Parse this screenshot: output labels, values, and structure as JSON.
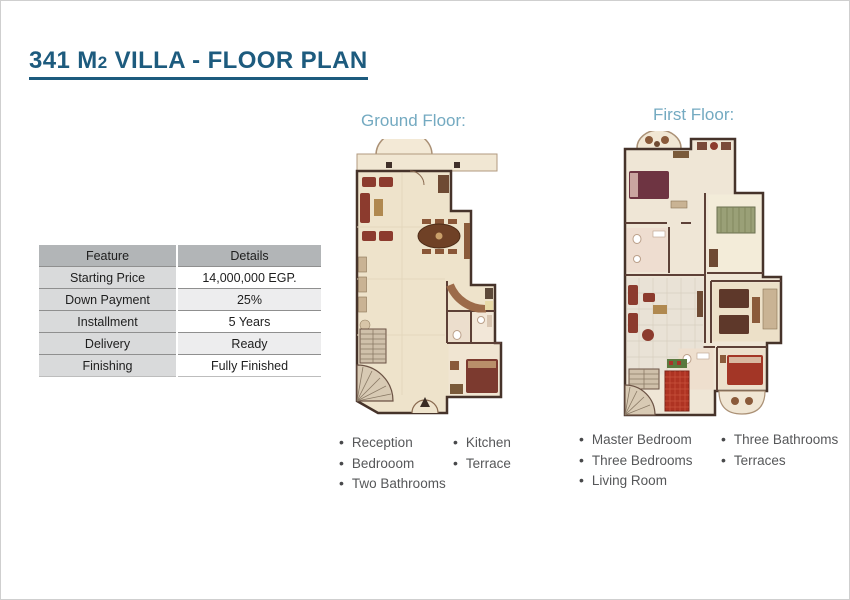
{
  "page": {
    "title": {
      "prefix": "341 M",
      "sup": "2",
      "suffix": " VILLA - FLOOR PLAN"
    }
  },
  "table": {
    "headers": [
      "Feature",
      "Details"
    ],
    "rows": [
      {
        "feature": "Starting Price",
        "details": "14,000,000 EGP."
      },
      {
        "feature": "Down Payment",
        "details": "25%"
      },
      {
        "feature": "Installment",
        "details": "5 Years"
      },
      {
        "feature": "Delivery",
        "details": "Ready"
      },
      {
        "feature": "Finishing",
        "details": "Fully Finished"
      }
    ]
  },
  "sections": {
    "ground": {
      "label": "Ground Floor:",
      "items_col1": [
        "Reception",
        "Bedrooom",
        "Two Bathrooms"
      ],
      "items_col2": [
        "Kitchen",
        "Terrace"
      ]
    },
    "first": {
      "label": "First Floor:",
      "items_col1": [
        "Master Bedroom",
        "Three Bedrooms",
        "Living Room"
      ],
      "items_col2": [
        "Three Bathrooms",
        "Terraces"
      ]
    }
  },
  "colors": {
    "title_blue": "#1d5b7e",
    "section_label_blue": "#74aac1",
    "body_text_gray": "#58595b",
    "table_header_bg": "#b2b5b7",
    "table_feature_bg": "#d9dadb",
    "table_alt_row_bg": "#ededee",
    "plan_wall_brown": "#46332a",
    "plan_floor_cream": "#eee3cb",
    "furniture_red": "#8c3b2e",
    "terrace_tile_red": "#ae3322"
  }
}
